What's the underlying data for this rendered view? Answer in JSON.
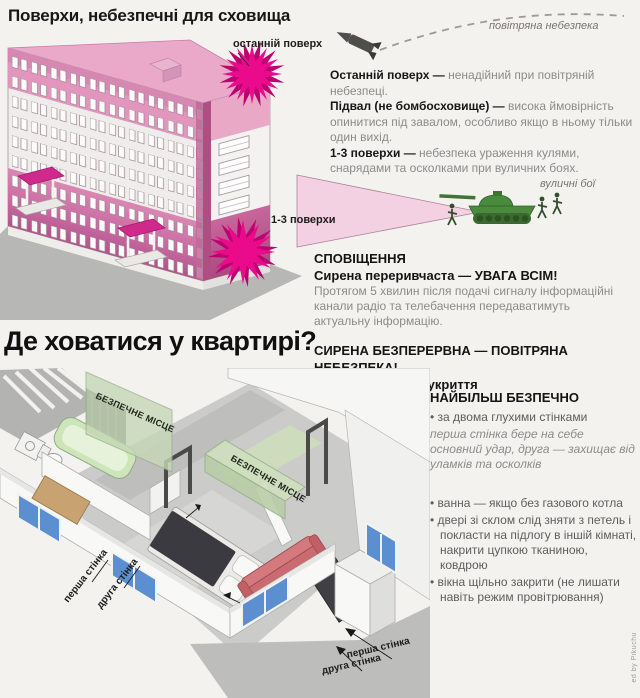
{
  "top": {
    "title": "Поверхи, небезпечні для сховища",
    "air_label": "повітряна небезпека",
    "last_floor_tag": "останній поверх",
    "floors_tag": "1-3 поверхи",
    "street_tag": "вуличні бої",
    "items": [
      {
        "lead": "Останній поверх — ",
        "rest": "ненадійний при повітряній небезпеці."
      },
      {
        "lead": "Підвал (не бомбосховище) — ",
        "rest": "висока ймовірність опинитися під завалом, особливо якщо в ньому тільки один вихід."
      },
      {
        "lead": "1-3 поверхи — ",
        "rest": "небезпека ураження кулями, снарядами та осколками при вуличних боях."
      }
    ],
    "alert": {
      "heading": "СПОВІЩЕННЯ",
      "intermittent": "Сирена переривчаста — УВАГА ВСІМ!",
      "details": "Протягом 5 хвилин після подачі сигналу інформаційні канали радіо та телебачення передаватимуть актуальну інформацію.",
      "continuous": "СИРЕНА БЕЗПЕРЕРВНА — ПОВІТРЯНА НЕБЕЗПЕКА!",
      "action": "Негайно шукайте укриття"
    }
  },
  "bottom": {
    "title": "Де ховатися у квартирі?",
    "safe_place": "БЕЗПЕЧНЕ МІСЦЕ",
    "first_wall": "перша стінка",
    "second_wall": "друга стінка",
    "safest_heading": "НАЙБІЛЬШ БЕЗПЕЧНО",
    "bullet_char": "•",
    "bullets": [
      {
        "text": "за двома глухими стінками",
        "note": "перша стінка бере на себе основний удар, друга — захищає від уламків та осколків"
      },
      {
        "text": "ванна — якщо без газового котла",
        "note": ""
      },
      {
        "text": "двері зі склом слід зняти з петель і покласти на підлогу в іншій кімнаті, накрити цупкою тканиною, ковдрою",
        "note": ""
      },
      {
        "text": "вікна щільно закрити (не лишати навіть режим провітрювання)",
        "note": ""
      }
    ]
  },
  "meta": {
    "watermark": "ed by Pikuchu"
  },
  "colors": {
    "magenta": "#eb0a8c",
    "magenta_dark": "#bc0070",
    "pink_roof": "#eba9c9",
    "pink_band": "#d27fae",
    "beam": "#f4d0e3",
    "tank_green": "#4a8a3c",
    "safe_green": "#cfe0be",
    "window_blue": "#5b8fd0",
    "text_gray": "#8b8b89",
    "text_dark": "#161616"
  }
}
